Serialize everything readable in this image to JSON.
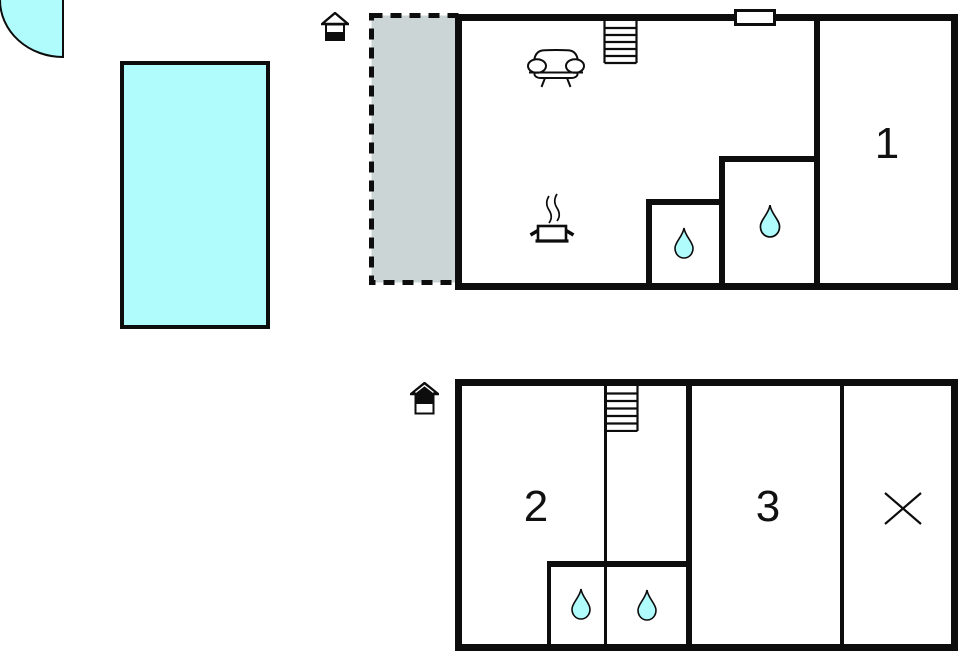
{
  "title": "holiday-home-floor-plan",
  "colors": {
    "water_fill": "#b0fbfc",
    "terrace_fill": "#cbd5d6",
    "wall": "#0d0d0d",
    "background": "#ffffff"
  },
  "outdoor": {
    "pool_icon": "swimming-pool",
    "corner_icon": "quarter-circle-water-corner"
  },
  "ground_floor": {
    "floor_icon": "house-level-ground-icon",
    "terrace_icon": "dashed-terrace-area",
    "icons": [
      "stairs-icon",
      "sofa-icon",
      "stove-icon",
      "window",
      "water-drop-icon",
      "water-drop-icon"
    ],
    "rooms": {
      "room1_label": "1"
    }
  },
  "upper_floor": {
    "floor_icon": "house-level-upper-icon",
    "icons": [
      "stairs-icon",
      "water-drop-icon",
      "water-drop-icon",
      "crossed-area-icon"
    ],
    "rooms": {
      "room2_label": "2",
      "room3_label": "3"
    }
  }
}
